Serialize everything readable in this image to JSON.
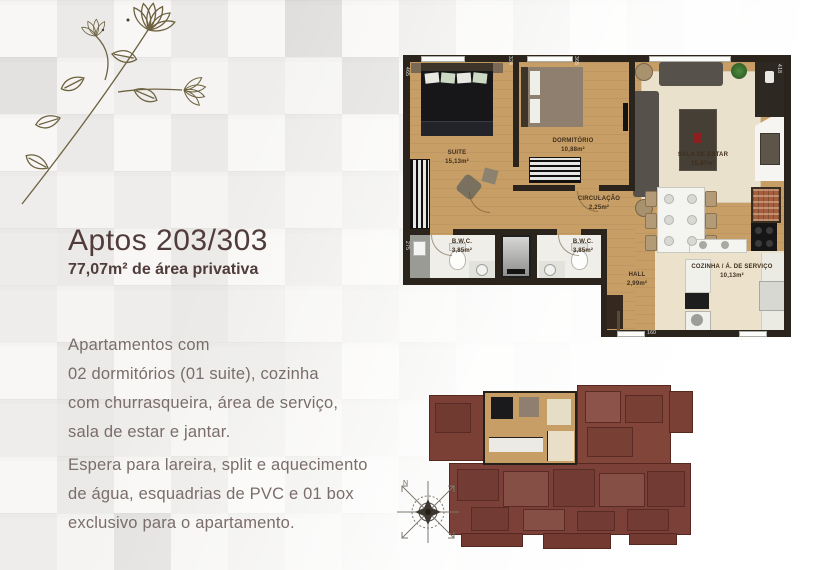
{
  "left_panel": {
    "title": "Aptos 203/303",
    "subtitle": "77,07m² de área privativa",
    "paragraph1": [
      "Apartamentos com",
      "02 dormitórios (01 suite), cozinha",
      "com churrasqueira, área de serviço,",
      "sala de estar e jantar."
    ],
    "paragraph2": [
      "Espera para lareira, split e aquecimento",
      "de água, esquadrias de PVC e 01 box",
      "exclusivo para o apartamento."
    ]
  },
  "floor_plan": {
    "rooms": {
      "suite": {
        "name": "SUITE",
        "area": "15,13m²"
      },
      "dormitorio": {
        "name": "DORMITÓRIO",
        "area": "10,88m²"
      },
      "sala_de_estar": {
        "name": "SALA DE ESTAR",
        "area": "15,87m²"
      },
      "circulacao": {
        "name": "CIRCULAÇÃO",
        "area": "2,25m²"
      },
      "bwc_suite": {
        "name": "B.W.C.",
        "area": "3,85m²"
      },
      "bwc_social": {
        "name": "B.W.C.",
        "area": "3,85m²"
      },
      "hall": {
        "name": "HALL",
        "area": "2,99m²"
      },
      "cozinha": {
        "name": "COZINHA / Á. DE SERVIÇO",
        "area": "10,13m²"
      }
    },
    "wall_dimensions": {
      "left_top": "465",
      "top_a": "324",
      "top_b": "365",
      "right_top": "418",
      "left_bwc": "275",
      "bottom_hall": "160"
    }
  },
  "site_plan": {
    "compass_north_label": "N"
  },
  "colors": {
    "accent_text": "#503c3a",
    "body_text": "#7a6d6b",
    "wood_floor": "#c79e66",
    "wall": "#2a241c",
    "site_maroon": "#7e4238"
  }
}
